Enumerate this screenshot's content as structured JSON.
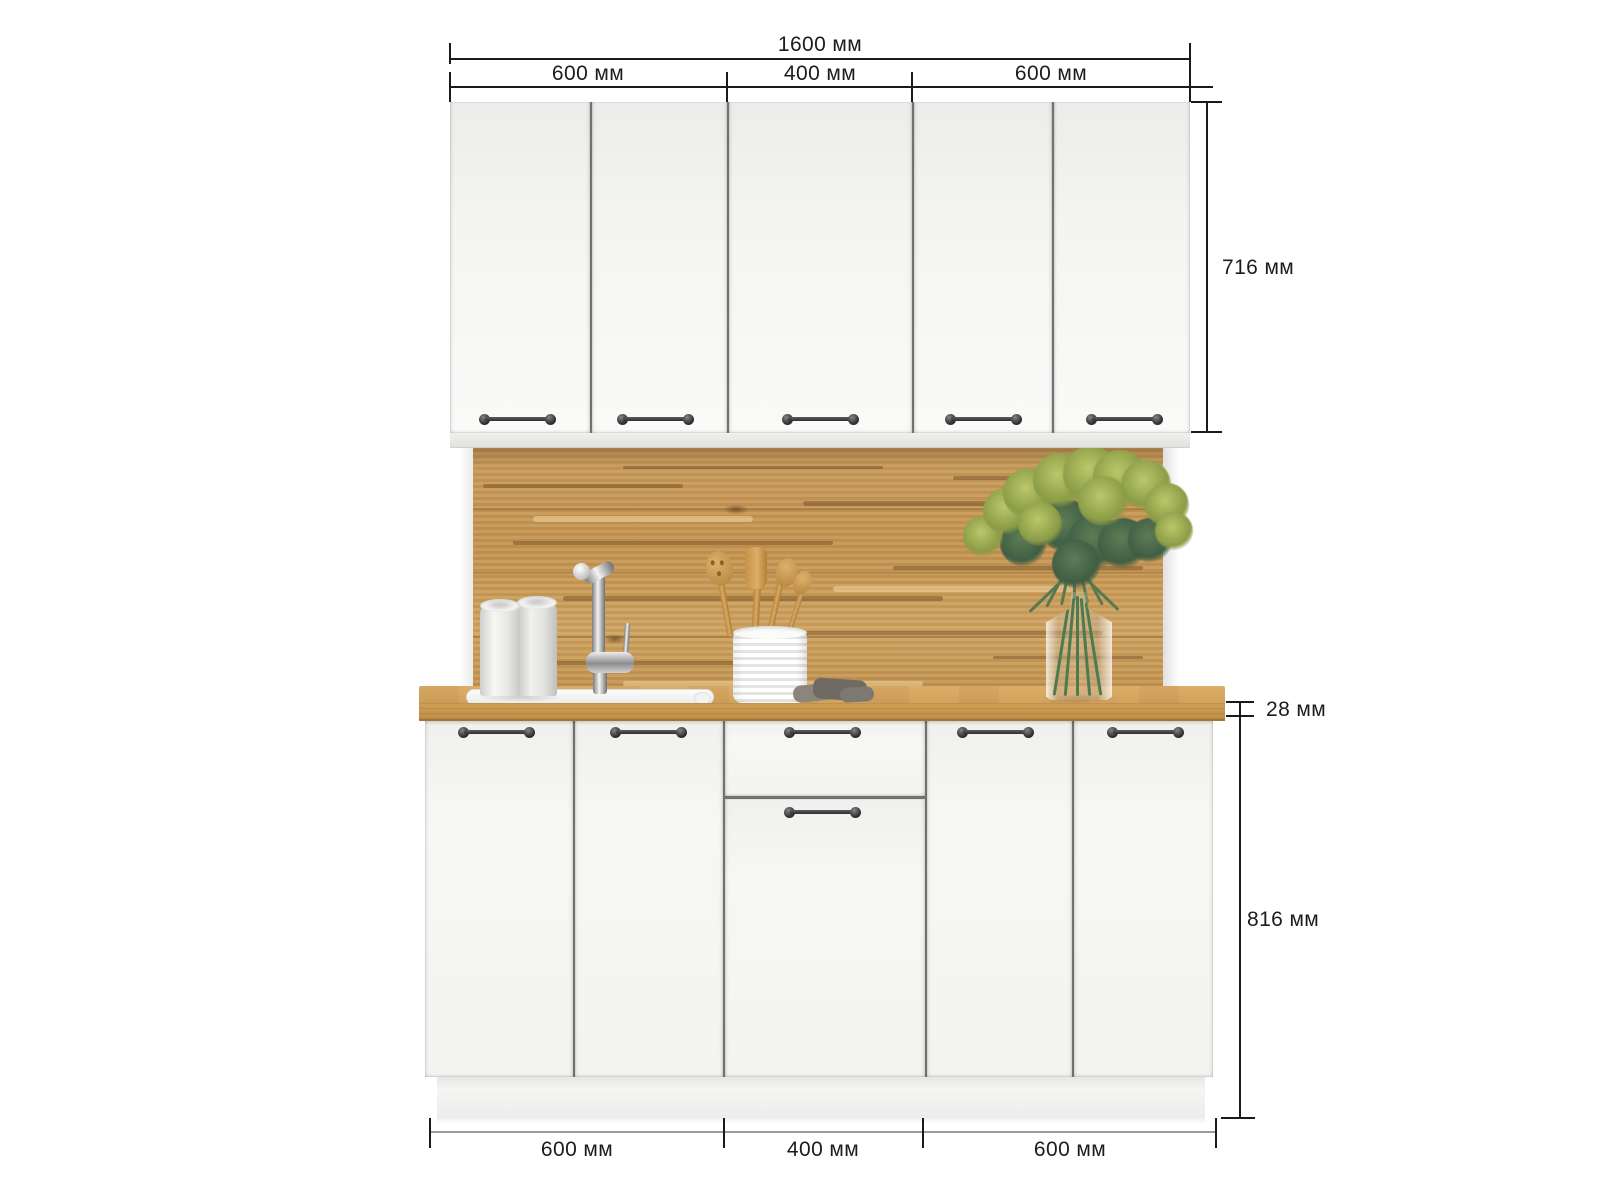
{
  "page": {
    "background": "#ffffff",
    "content": "kitchen cabinet set front-view dimension diagram"
  },
  "dimensions": {
    "unit": "мм",
    "total_width_label": "1600 мм",
    "top_segments": [
      {
        "label": "600 мм"
      },
      {
        "label": "400 мм"
      },
      {
        "label": "600 мм"
      }
    ],
    "upper_cabinet_height_label": "716 мм",
    "countertop_thickness_label": "28 мм",
    "base_cabinet_height_label": "816 мм",
    "bottom_segments": [
      {
        "label": "600 мм"
      },
      {
        "label": "400 мм"
      },
      {
        "label": "600 мм"
      }
    ]
  },
  "colors": {
    "dimension_line": "#1a1a1a",
    "bottom_dimension_line": "#9b9b9b",
    "label_text": "#1c1c1c",
    "door_white": "#f6f6f4",
    "gap_line": "#72716f",
    "wood_backsplash": "#c2955a",
    "wood_countertop": "#cda05c",
    "handle_black": "#2d2d2d",
    "greenery_green": "#6f8a4b"
  },
  "scene": {
    "upper_door_count": 5,
    "base_door_count": 5,
    "base_drawer_count": 1,
    "props": [
      "paper-towel-rolls",
      "kitchen-sink",
      "chrome-faucet",
      "utensil-crock",
      "wooden-utensils",
      "dish-cloth",
      "glass-vase-with-greenery"
    ]
  }
}
